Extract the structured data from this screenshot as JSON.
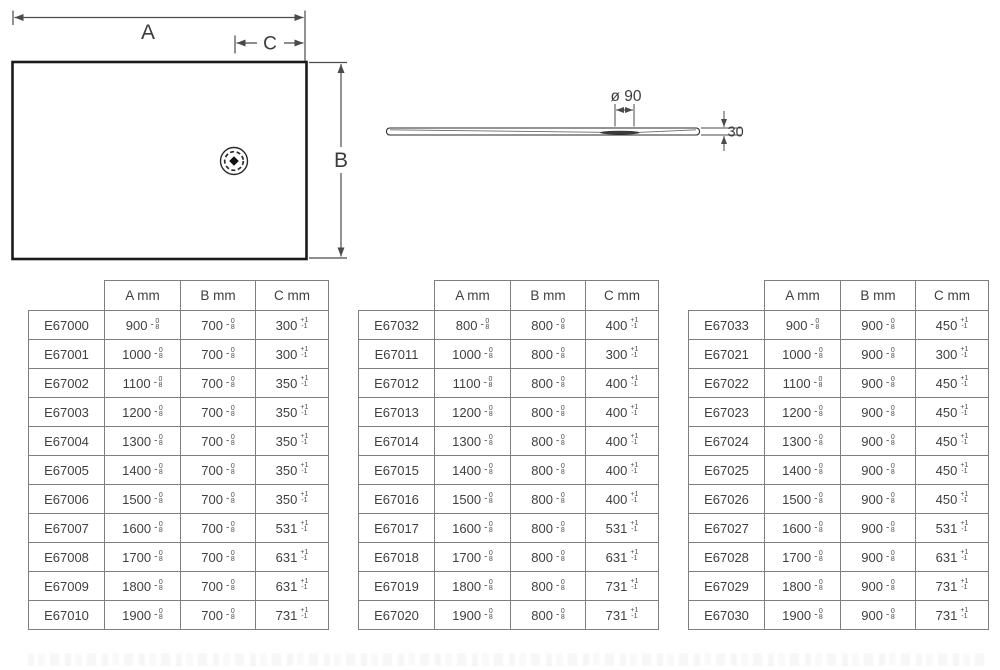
{
  "colors": {
    "outline": "#1a1a1a",
    "dimension_line": "#4a4a4a",
    "table_border": "#7e7e7e",
    "text": "#3f3f3f",
    "drain_recess_fill": "#3a3a3a"
  },
  "diagram": {
    "plan": {
      "label_a": "A",
      "label_b": "B",
      "label_c": "C"
    },
    "side": {
      "diameter_label": "ø 90",
      "thickness_label": "30"
    }
  },
  "column_headers": [
    "A mm",
    "B mm",
    "C mm"
  ],
  "tolerances": {
    "ab": {
      "sign": "-",
      "upper": "0",
      "lower": "8"
    },
    "c": {
      "upper": "+1",
      "lower": "-1"
    }
  },
  "tables": [
    {
      "rows": [
        {
          "code": "E67000",
          "a": "900",
          "b": "700",
          "c": "300"
        },
        {
          "code": "E67001",
          "a": "1000",
          "b": "700",
          "c": "300"
        },
        {
          "code": "E67002",
          "a": "1100",
          "b": "700",
          "c": "350"
        },
        {
          "code": "E67003",
          "a": "1200",
          "b": "700",
          "c": "350"
        },
        {
          "code": "E67004",
          "a": "1300",
          "b": "700",
          "c": "350"
        },
        {
          "code": "E67005",
          "a": "1400",
          "b": "700",
          "c": "350"
        },
        {
          "code": "E67006",
          "a": "1500",
          "b": "700",
          "c": "350"
        },
        {
          "code": "E67007",
          "a": "1600",
          "b": "700",
          "c": "531"
        },
        {
          "code": "E67008",
          "a": "1700",
          "b": "700",
          "c": "631"
        },
        {
          "code": "E67009",
          "a": "1800",
          "b": "700",
          "c": "631"
        },
        {
          "code": "E67010",
          "a": "1900",
          "b": "700",
          "c": "731"
        }
      ]
    },
    {
      "rows": [
        {
          "code": "E67032",
          "a": "800",
          "b": "800",
          "c": "400"
        },
        {
          "code": "E67011",
          "a": "1000",
          "b": "800",
          "c": "300"
        },
        {
          "code": "E67012",
          "a": "1100",
          "b": "800",
          "c": "400"
        },
        {
          "code": "E67013",
          "a": "1200",
          "b": "800",
          "c": "400"
        },
        {
          "code": "E67014",
          "a": "1300",
          "b": "800",
          "c": "400"
        },
        {
          "code": "E67015",
          "a": "1400",
          "b": "800",
          "c": "400"
        },
        {
          "code": "E67016",
          "a": "1500",
          "b": "800",
          "c": "400"
        },
        {
          "code": "E67017",
          "a": "1600",
          "b": "800",
          "c": "531"
        },
        {
          "code": "E67018",
          "a": "1700",
          "b": "800",
          "c": "631"
        },
        {
          "code": "E67019",
          "a": "1800",
          "b": "800",
          "c": "731"
        },
        {
          "code": "E67020",
          "a": "1900",
          "b": "800",
          "c": "731"
        }
      ]
    },
    {
      "rows": [
        {
          "code": "E67033",
          "a": "900",
          "b": "900",
          "c": "450"
        },
        {
          "code": "E67021",
          "a": "1000",
          "b": "900",
          "c": "300"
        },
        {
          "code": "E67022",
          "a": "1100",
          "b": "900",
          "c": "450"
        },
        {
          "code": "E67023",
          "a": "1200",
          "b": "900",
          "c": "450"
        },
        {
          "code": "E67024",
          "a": "1300",
          "b": "900",
          "c": "450"
        },
        {
          "code": "E67025",
          "a": "1400",
          "b": "900",
          "c": "450"
        },
        {
          "code": "E67026",
          "a": "1500",
          "b": "900",
          "c": "450"
        },
        {
          "code": "E67027",
          "a": "1600",
          "b": "900",
          "c": "531"
        },
        {
          "code": "E67028",
          "a": "1700",
          "b": "900",
          "c": "631"
        },
        {
          "code": "E67029",
          "a": "1800",
          "b": "900",
          "c": "731"
        },
        {
          "code": "E67030",
          "a": "1900",
          "b": "900",
          "c": "731"
        }
      ]
    }
  ],
  "table_positions_px": [
    28,
    358,
    688
  ]
}
